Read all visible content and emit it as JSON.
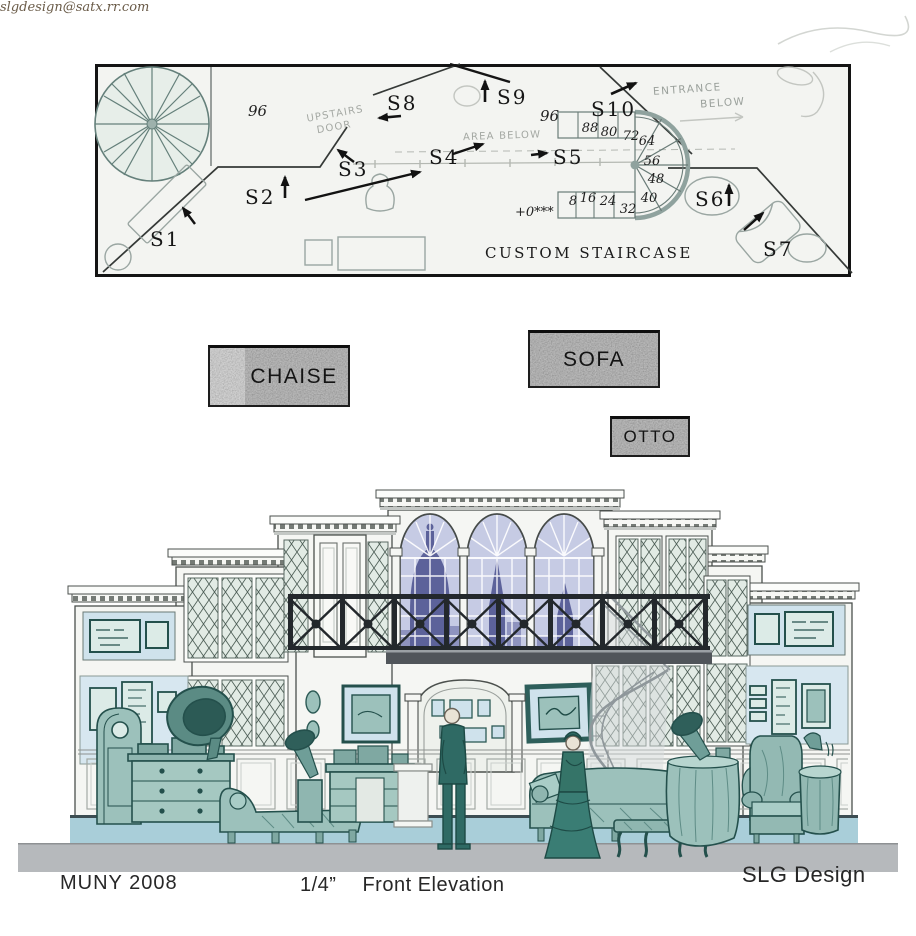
{
  "plan": {
    "caption": "CUSTOM STAIRCASE",
    "datum_note": "+0***",
    "dim_left": "96",
    "dim_right": "96",
    "treads": [
      "8",
      "16",
      "24",
      "32",
      "40",
      "48",
      "56",
      "64",
      "72",
      "80",
      "88"
    ],
    "set_pieces": [
      {
        "label": "S1"
      },
      {
        "label": "S2"
      },
      {
        "label": "S3"
      },
      {
        "label": "S4"
      },
      {
        "label": "S5"
      },
      {
        "label": "S6"
      },
      {
        "label": "S7"
      },
      {
        "label": "S8"
      },
      {
        "label": "S9"
      },
      {
        "label": "S10"
      }
    ],
    "pencil_notes": {
      "entrance_1": "ENTRANCE",
      "entrance_2": "BELOW",
      "upstairs_1": "UPSTAIRS",
      "upstairs_2": "DOOR",
      "area_below": "AREA BELOW"
    }
  },
  "swatches": {
    "chaise": {
      "label": "CHAISE"
    },
    "sofa": {
      "label": "SOFA"
    },
    "otto": {
      "label": "OTTO"
    }
  },
  "footer": {
    "production": "MUNY 2008",
    "scale": "1/4”",
    "drawing_title": "Front Elevation",
    "designer": "SLG Design",
    "email": "slgdesign@satx.rr.com"
  },
  "colors": {
    "ink": "#161616",
    "pencil": "#a4a8a3",
    "plan_paper": "#f3f4f1",
    "stair_outline": "#8fa29e",
    "swatch_gray": "#9d9d9d",
    "swatch_light_strip": "#cfcfcf",
    "wall_white": "#f5f6f3",
    "leaded_glass": "#e2ebe5",
    "lattice": "#51625a",
    "arch_glass": "#c6cbe4",
    "skyline_blue": "#5c629a",
    "skyline_light": "#8e93bf",
    "iron_railing": "#23282c",
    "picture_panel_blue": "#cfe2ec",
    "furniture_teal": "#2e5f5b",
    "floor_strip_blue": "#a9ced9",
    "stage_gray": "#b6b9bc",
    "email_brown": "#6a5b48"
  }
}
